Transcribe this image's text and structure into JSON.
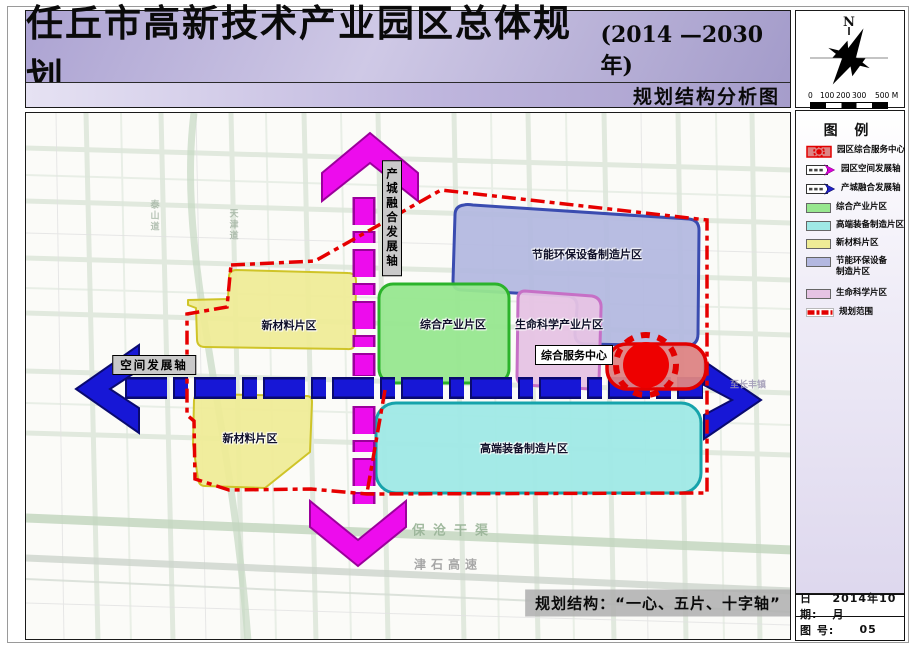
{
  "title": {
    "main": "任丘市高新技术产业园区总体规划",
    "year": "(2014 —2030年)",
    "subtitle": "规划结构分析图"
  },
  "compass": {
    "north": "N",
    "ticks": [
      "0",
      "100",
      "200",
      "300"
    ],
    "scale_unit": "500 M"
  },
  "legend": {
    "title": "图  例",
    "items": [
      {
        "label": "园区综合服务中心"
      },
      {
        "label": "园区空间发展轴"
      },
      {
        "label": "产城融合发展轴"
      },
      {
        "label": "综合产业片区"
      },
      {
        "label": "高端装备制造片区"
      },
      {
        "label": "新材料片区"
      },
      {
        "label": "节能环保设备",
        "label2": "制造片区"
      },
      {
        "label": "生命科学片区"
      },
      {
        "label": "规划范围"
      }
    ]
  },
  "map": {
    "labels": {
      "energy_env": "节能环保设备制造片区",
      "new_materials_north": "新材料片区",
      "new_materials_south": "新材料片区",
      "comprehensive_industry": "综合产业片区",
      "life_science": "生命科学产业片区",
      "highend_equipment": "高端装备制造片区",
      "service_center": "综合服务中心",
      "axis_horizontal": "空间发展轴",
      "axis_vertical": "产城融合发展轴",
      "caption": "规划结构：“一心、五片、十字轴”"
    },
    "background_labels": {
      "canal": "保沧干渠",
      "highway": "津石高速",
      "road_1": "泰山道",
      "road_2": "天津道",
      "road_3": "至长丰镇"
    }
  },
  "titleblock": {
    "date_label": "日  期:",
    "date_value": "2014年10月",
    "sheet_label": "图  号:",
    "sheet_value": "05"
  },
  "colors": {
    "boundary_red": "#e60000",
    "axis_blue": "#1717d6",
    "axis_magenta": "#ed0ced",
    "industry_green": "#97e78f",
    "equipment_cyan": "#9fe9e6",
    "materials_yellow": "#efec96",
    "energy_periwinkle": "#b3b8e0",
    "life_pink": "#e6c3e4",
    "service_red_fill": "#dd8484",
    "titlebar_purple": "#a89fd0"
  }
}
